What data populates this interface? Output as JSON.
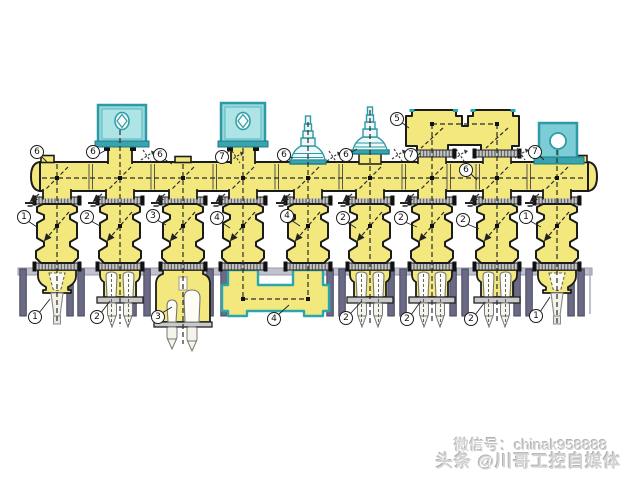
{
  "watermark": {
    "line1": "微信号：chinak958888",
    "line2": "头条 @川哥工控自媒体"
  },
  "callouts": [
    {
      "n": "6"
    },
    {
      "n": "6"
    },
    {
      "n": "6"
    },
    {
      "n": "7"
    },
    {
      "n": "6"
    },
    {
      "n": "6"
    },
    {
      "n": "5"
    },
    {
      "n": "7"
    },
    {
      "n": "6"
    },
    {
      "n": "7"
    },
    {
      "n": "1"
    },
    {
      "n": "2"
    },
    {
      "n": "3"
    },
    {
      "n": "4"
    },
    {
      "n": "4"
    },
    {
      "n": "2"
    },
    {
      "n": "2"
    },
    {
      "n": "2"
    },
    {
      "n": "1"
    },
    {
      "n": "1"
    },
    {
      "n": "2"
    },
    {
      "n": "3"
    },
    {
      "n": "4"
    },
    {
      "n": "2"
    },
    {
      "n": "2"
    },
    {
      "n": "2"
    },
    {
      "n": "1"
    }
  ],
  "colors": {
    "equipment_yellow": "#f2e87e",
    "accessory_cyan": "#8fd8dc",
    "teal_outline": "#2e9aa6",
    "support_slate": "#6a6a85",
    "outline_black": "#1b1b1b"
  }
}
